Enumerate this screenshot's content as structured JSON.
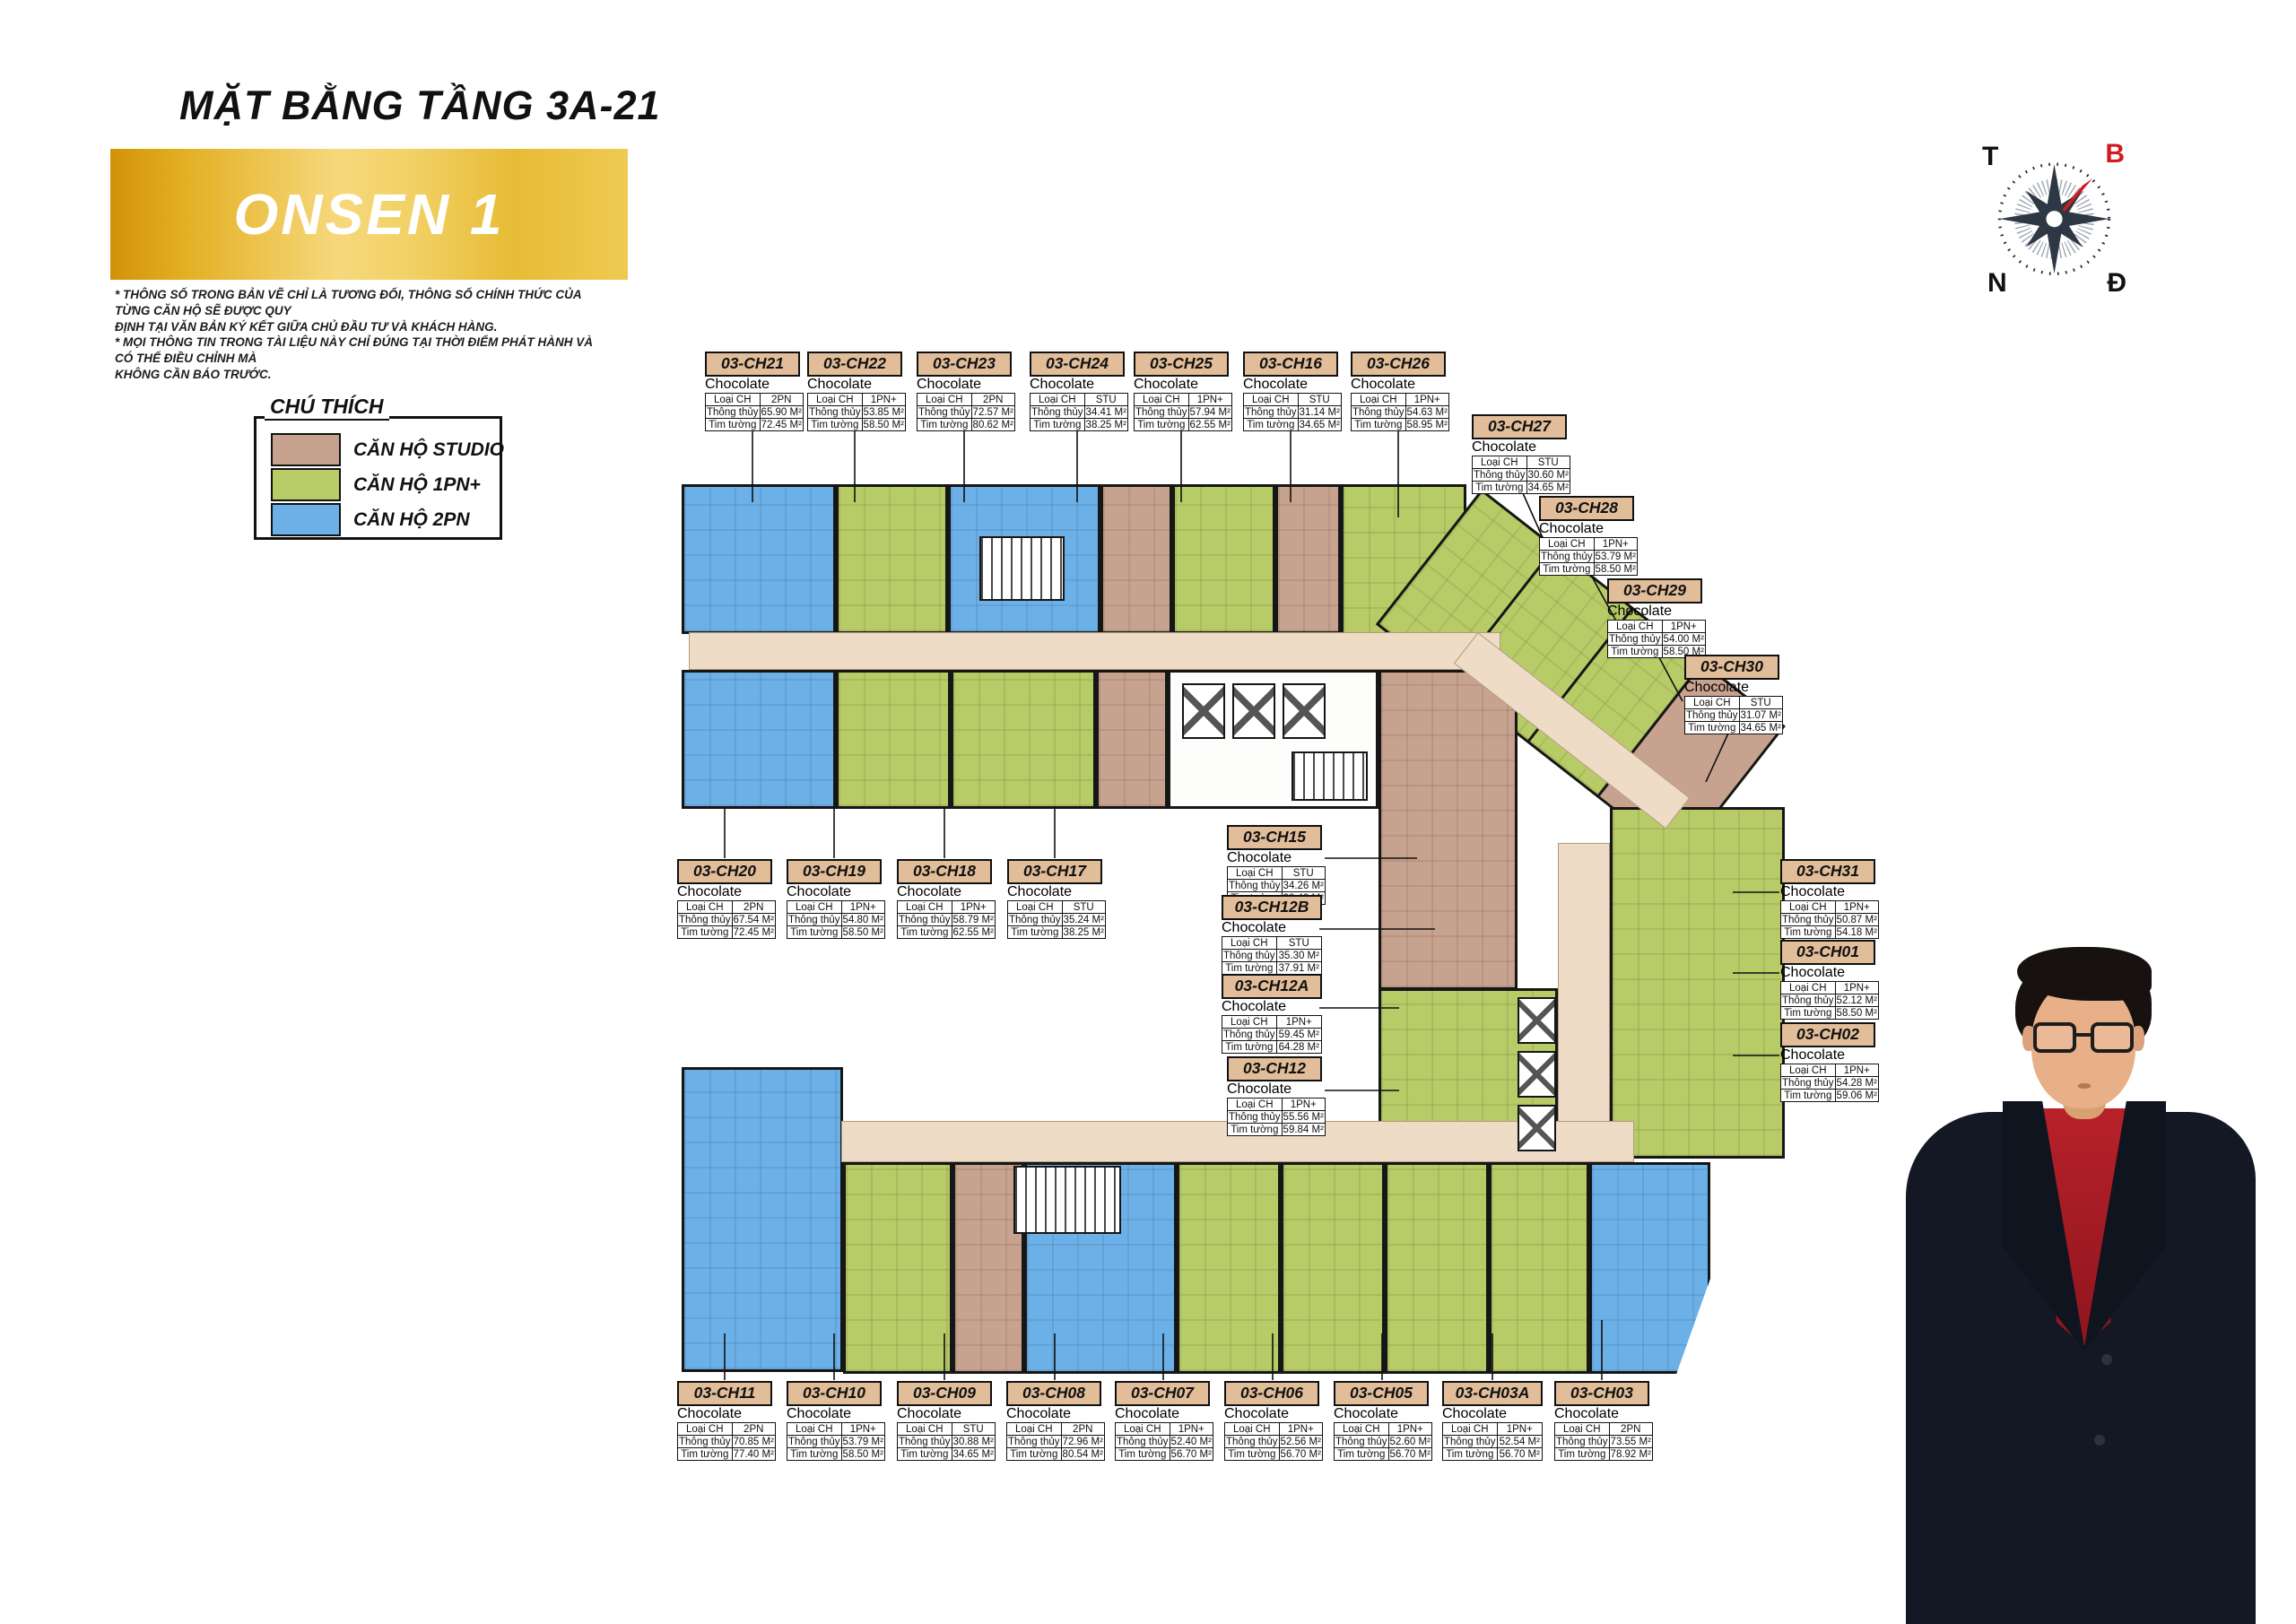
{
  "header": {
    "title": "MẶT BẰNG TẦNG 3A-21",
    "banner": "ONSEN 1",
    "disclaimer": "* THÔNG SỐ TRONG BẢN VẼ CHỈ LÀ TƯƠNG ĐỐI, THÔNG SỐ CHÍNH THỨC CỦA TỪNG CĂN HỘ SẼ ĐƯỢC QUY\nĐỊNH TẠI VĂN BẢN KÝ KẾT  GIỮA CHỦ ĐẦU TƯ VÀ KHÁCH HÀNG.\n* MỌI THÔNG TIN TRONG TÀI LIỆU NÀY CHỈ ĐÚNG TẠI THỜI ĐIỂM PHÁT HÀNH VÀ CÓ THỂ ĐIỀU CHỈNH MÀ\nKHÔNG CẦN BÁO TRƯỚC."
  },
  "legend": {
    "title": "CHÚ THÍCH",
    "items": [
      {
        "label": "CĂN HỘ STUDIO",
        "color": "#c7a28e"
      },
      {
        "label": "CĂN HỘ 1PN+",
        "color": "#b7cb66"
      },
      {
        "label": "CĂN HỘ 2PN",
        "color": "#6cb0e8"
      }
    ]
  },
  "compass": {
    "west": "T",
    "north": "B",
    "south": "N",
    "east": "Đ",
    "needle_color": "#d11a1f"
  },
  "unit_card_fields": {
    "type_label": "Loại CH",
    "net_label": "Thông thủy",
    "gross_label": "Tim tường"
  },
  "units": [
    {
      "code": "03-CH21",
      "type": "2PN",
      "net": "65.90 M²",
      "gross": "72.45 M²"
    },
    {
      "code": "03-CH22",
      "type": "1PN+",
      "net": "53.85 M²",
      "gross": "58.50 M²"
    },
    {
      "code": "03-CH23",
      "type": "2PN",
      "net": "72.57 M²",
      "gross": "80.62 M²"
    },
    {
      "code": "03-CH24",
      "type": "STU",
      "net": "34.41 M²",
      "gross": "38.25 M²"
    },
    {
      "code": "03-CH25",
      "type": "1PN+",
      "net": "57.94 M²",
      "gross": "62.55 M²"
    },
    {
      "code": "03-CH16",
      "type": "STU",
      "net": "31.14 M²",
      "gross": "34.65 M²"
    },
    {
      "code": "03-CH26",
      "type": "1PN+",
      "net": "54.63 M²",
      "gross": "58.95 M²"
    },
    {
      "code": "03-CH27",
      "type": "STU",
      "net": "30.60 M²",
      "gross": "34.65 M²"
    },
    {
      "code": "03-CH28",
      "type": "1PN+",
      "net": "53.79 M²",
      "gross": "58.50 M²"
    },
    {
      "code": "03-CH29",
      "type": "1PN+",
      "net": "54.00 M²",
      "gross": "58.50 M²"
    },
    {
      "code": "03-CH30",
      "type": "STU",
      "net": "31.07 M²",
      "gross": "34.65 M²"
    },
    {
      "code": "03-CH20",
      "type": "2PN",
      "net": "67.54 M²",
      "gross": "72.45 M²"
    },
    {
      "code": "03-CH19",
      "type": "1PN+",
      "net": "54.80 M²",
      "gross": "58.50 M²"
    },
    {
      "code": "03-CH18",
      "type": "1PN+",
      "net": "58.79 M²",
      "gross": "62.55 M²"
    },
    {
      "code": "03-CH17",
      "type": "STU",
      "net": "35.24 M²",
      "gross": "38.25 M²"
    },
    {
      "code": "03-CH15",
      "type": "STU",
      "net": "34.26 M²",
      "gross": "38.48 M²"
    },
    {
      "code": "03-CH12B",
      "type": "STU",
      "net": "35.30 M²",
      "gross": "37.91 M²"
    },
    {
      "code": "03-CH12A",
      "type": "1PN+",
      "net": "59.45 M²",
      "gross": "64.28 M²"
    },
    {
      "code": "03-CH12",
      "type": "1PN+",
      "net": "55.56 M²",
      "gross": "59.84 M²"
    },
    {
      "code": "03-CH31",
      "type": "1PN+",
      "net": "50.87 M²",
      "gross": "54.18 M²"
    },
    {
      "code": "03-CH01",
      "type": "1PN+",
      "net": "52.12 M²",
      "gross": "58.50 M²"
    },
    {
      "code": "03-CH02",
      "type": "1PN+",
      "net": "54.28 M²",
      "gross": "59.06 M²"
    },
    {
      "code": "03-CH11",
      "type": "2PN",
      "net": "70.85 M²",
      "gross": "77.40 M²"
    },
    {
      "code": "03-CH10",
      "type": "1PN+",
      "net": "53.79 M²",
      "gross": "58.50 M²"
    },
    {
      "code": "03-CH09",
      "type": "STU",
      "net": "30.88 M²",
      "gross": "34.65 M²"
    },
    {
      "code": "03-CH08",
      "type": "2PN",
      "net": "72.96 M²",
      "gross": "80.54 M²"
    },
    {
      "code": "03-CH07",
      "type": "1PN+",
      "net": "52.40 M²",
      "gross": "56.70 M²"
    },
    {
      "code": "03-CH06",
      "type": "1PN+",
      "net": "52.56 M²",
      "gross": "56.70 M²"
    },
    {
      "code": "03-CH05",
      "type": "1PN+",
      "net": "52.60 M²",
      "gross": "56.70 M²"
    },
    {
      "code": "03-CH03A",
      "type": "1PN+",
      "net": "52.54 M²",
      "gross": "56.70 M²"
    },
    {
      "code": "03-CH03",
      "type": "2PN",
      "net": "73.55 M²",
      "gross": "78.92 M²"
    }
  ],
  "colors": {
    "studio": "#c7a28e",
    "one_pn_plus": "#b7cb66",
    "two_pn": "#6cb0e8",
    "corridor": "#efdcc6",
    "banner_gold": "#e7bb35",
    "card_header": "#e1bd99"
  }
}
